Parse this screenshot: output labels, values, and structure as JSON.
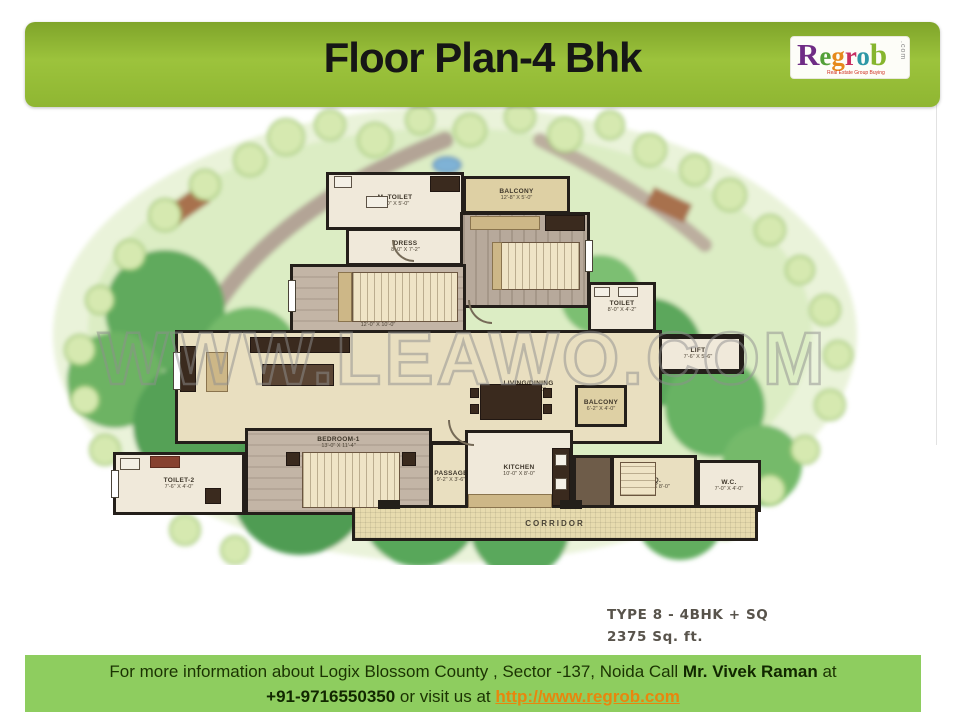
{
  "header": {
    "title": "Floor Plan-4 Bhk",
    "logo": {
      "letters": [
        {
          "ch": "R",
          "color": "#6f2c85"
        },
        {
          "ch": "e",
          "color": "#53a039"
        },
        {
          "ch": "g",
          "color": "#e6891c"
        },
        {
          "ch": "r",
          "color": "#c62e63"
        },
        {
          "ch": "o",
          "color": "#2e97a6"
        },
        {
          "ch": "b",
          "color": "#86b52e"
        }
      ],
      "com": ".com",
      "tagline": "Real Estate Group Buying"
    }
  },
  "watermark": {
    "text": "WWW.LEAWO.COM"
  },
  "plan": {
    "type_label": "TYPE 8 - 4BHK + SQ",
    "area_label": "2375 Sq. ft.",
    "rooms": [
      {
        "label": "M. TOILET",
        "dims": "8'-0\" X 5'-0\""
      },
      {
        "label": "DRESS",
        "dims": "8'-0\" X 7'-2\""
      },
      {
        "label": "BALCONY",
        "dims": "12'-8\" X 5'-0\""
      },
      {
        "label": "BEDROOM",
        "dims": "14'-0\" X 11'-0\""
      },
      {
        "label": "BEDROOM-2",
        "dims": "12'-0\" X 10'-0\""
      },
      {
        "label": "TOILET",
        "dims": "8'-0\" X 4'-2\""
      },
      {
        "label": "LIFT",
        "dims": "7'-6\" X 5'-6\""
      },
      {
        "label": "LIVING/DINING",
        "dims": "22'-8\" X 12'-0\""
      },
      {
        "label": "PASSAGE",
        "dims": "9'-2\" X 3'-6\""
      },
      {
        "label": "KITCHEN",
        "dims": "10'-0\" X 8'-0\""
      },
      {
        "label": "BEDROOM-1",
        "dims": "13'-0\" X 11'-4\""
      },
      {
        "label": "TOILET-2",
        "dims": "7'-6\" X 4'-0\""
      },
      {
        "label": "BALCONY",
        "dims": "6'-2\" X 4'-0\""
      },
      {
        "label": "S.Q.",
        "dims": "10'-0\" X 8'-0\""
      },
      {
        "label": "W.C.",
        "dims": "7'-0\" X 4'-0\""
      },
      {
        "label": "CORRIDOR",
        "dims": ""
      }
    ]
  },
  "footer": {
    "line1": {
      "pre": "For more information about Logix Blossom  County , Sector -137, Noida Call ",
      "bold": "Mr. Vivek Raman",
      "post": " at"
    },
    "line2": {
      "bold": "+91-9716550350",
      "mid": " or visit us at ",
      "link": "http://www.regrob.com"
    }
  },
  "colors": {
    "header_green": "#8fb632",
    "footer_green": "#8ecd5f",
    "link_orange": "#e8860d",
    "wall": "#241f1a",
    "tree_green": "#5ba75c",
    "watermark_grey": "#8f8f8f"
  }
}
